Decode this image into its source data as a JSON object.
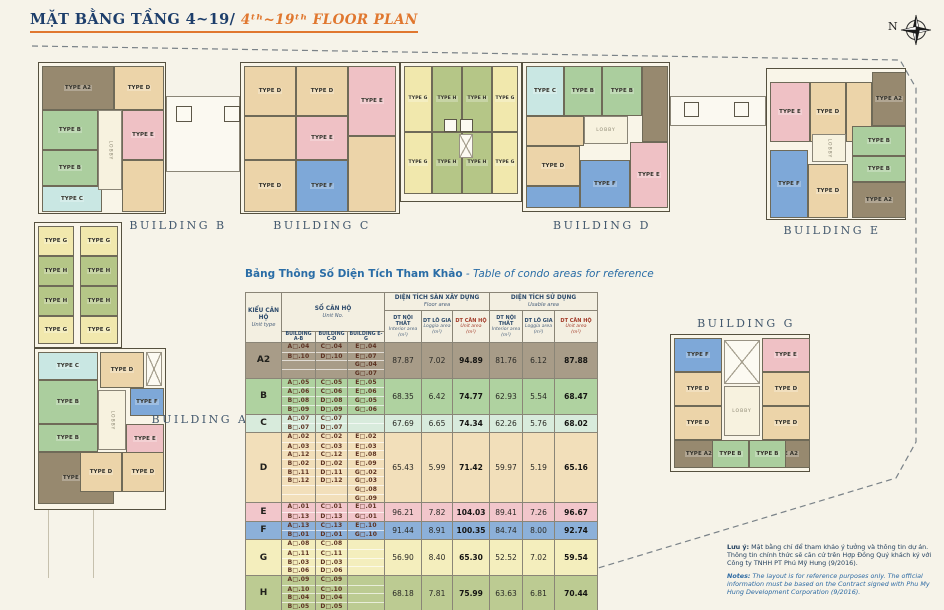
{
  "title": {
    "vi": "MẶT BẰNG TẦNG 4~19/ ",
    "en": "4ᵗʰ~19ᵗʰ FLOOR PLAN"
  },
  "compass": {
    "label": "N"
  },
  "plan": {
    "types": {
      "A2": {
        "label": "TYPE A2",
        "color": "#97896f"
      },
      "B": {
        "label": "TYPE B",
        "color": "#abce9e"
      },
      "C": {
        "label": "TYPE C",
        "color": "#c9e7e3"
      },
      "D": {
        "label": "TYPE D",
        "color": "#ecd4a9"
      },
      "E": {
        "label": "TYPE E",
        "color": "#efc1c5"
      },
      "F": {
        "label": "TYPE F",
        "color": "#7ea8d8"
      },
      "G": {
        "label": "TYPE G",
        "color": "#f1e8ad"
      },
      "H": {
        "label": "TYPE H",
        "color": "#b5c687"
      }
    },
    "lobby_label": "LOBBY",
    "buildings": [
      "BUILDING A",
      "BUILDING B",
      "BUILDING C",
      "BUILDING D",
      "BUILDING E",
      "BUILDING G"
    ]
  },
  "table": {
    "title_vi": "Bảng Thông Số Diện Tích Tham Khảo",
    "title_en": " - Table of condo areas for reference",
    "header": {
      "unit_type_vi": "KIỂU CĂN HỘ",
      "unit_type_en": "Unit type",
      "unit_no_vi": "SỐ CĂN HỘ",
      "unit_no_en": "Unit No.",
      "buildings": [
        "BUILDING A-B",
        "BUILDING C-D",
        "BUILDING E-G"
      ],
      "floor_vi": "DIỆN TÍCH SÀN XÂY DỰNG",
      "floor_en": "Floor area",
      "usable_vi": "DIỆN TÍCH SỬ DỤNG",
      "usable_en": "Usable area",
      "cols": [
        {
          "vi": "DT NỘI THẤT",
          "en": "Interior area",
          "unit": "(m²)",
          "highlight": false
        },
        {
          "vi": "DT LÔ GIA",
          "en": "Loggia area",
          "unit": "(m²)",
          "highlight": false
        },
        {
          "vi": "DT CĂN HỘ",
          "en": "Unit area",
          "unit": "(m²)",
          "highlight": true
        }
      ]
    },
    "rows": [
      {
        "type": "A2",
        "color": "#a89c88",
        "ab": [
          "A□.04",
          "B□.10",
          "",
          ""
        ],
        "cd": [
          "C□.04",
          "D□.10",
          "",
          ""
        ],
        "eg": [
          "E□.04",
          "E□.07",
          "G□.04",
          "G□.07"
        ],
        "floor": [
          "87.87",
          "7.02",
          "94.89"
        ],
        "usable": [
          "81.76",
          "6.12",
          "87.88"
        ]
      },
      {
        "type": "B",
        "color": "#afd2a0",
        "ab": [
          "A□.05",
          "A□.06",
          "B□.08",
          "B□.09"
        ],
        "cd": [
          "C□.05",
          "C□.06",
          "D□.08",
          "D□.09"
        ],
        "eg": [
          "E□.05",
          "E□.06",
          "G□.05",
          "G□.06"
        ],
        "floor": [
          "68.35",
          "6.42",
          "74.77"
        ],
        "usable": [
          "62.93",
          "5.54",
          "68.47"
        ]
      },
      {
        "type": "C",
        "color": "#d8ebdc",
        "ab": [
          "A□.07",
          "B□.07"
        ],
        "cd": [
          "C□.07",
          "D□.07"
        ],
        "eg": [
          "",
          ""
        ],
        "floor": [
          "67.69",
          "6.65",
          "74.34"
        ],
        "usable": [
          "62.26",
          "5.76",
          "68.02"
        ]
      },
      {
        "type": "D",
        "color": "#f2dfba",
        "ab": [
          "A□.02",
          "A□.03",
          "A□.12",
          "B□.02",
          "B□.11",
          "B□.12",
          "",
          ""
        ],
        "cd": [
          "C□.02",
          "C□.03",
          "C□.12",
          "D□.02",
          "D□.11",
          "D□.12",
          "",
          ""
        ],
        "eg": [
          "E□.02",
          "E□.03",
          "E□.08",
          "E□.09",
          "G□.02",
          "G□.03",
          "G□.08",
          "G□.09"
        ],
        "floor": [
          "65.43",
          "5.99",
          "71.42"
        ],
        "usable": [
          "59.97",
          "5.19",
          "65.16"
        ]
      },
      {
        "type": "E",
        "color": "#f2c6cb",
        "ab": [
          "A□.01",
          "B□.13"
        ],
        "cd": [
          "C□.01",
          "D□.13"
        ],
        "eg": [
          "E□.01",
          "G□.01"
        ],
        "floor": [
          "96.21",
          "7.82",
          "104.03"
        ],
        "usable": [
          "89.41",
          "7.26",
          "96.67"
        ]
      },
      {
        "type": "F",
        "color": "#8cb0d9",
        "ab": [
          "A□.13",
          "B□.01"
        ],
        "cd": [
          "C□.13",
          "D□.01"
        ],
        "eg": [
          "E□.10",
          "G□.10"
        ],
        "floor": [
          "91.44",
          "8.91",
          "100.35"
        ],
        "usable": [
          "84.74",
          "8.00",
          "92.74"
        ]
      },
      {
        "type": "G",
        "color": "#f4eebd",
        "ab": [
          "A□.08",
          "A□.11",
          "B□.03",
          "B□.06"
        ],
        "cd": [
          "C□.08",
          "C□.11",
          "D□.03",
          "D□.06"
        ],
        "eg": [
          "",
          "",
          "",
          ""
        ],
        "floor": [
          "56.90",
          "8.40",
          "65.30"
        ],
        "usable": [
          "52.52",
          "7.02",
          "59.54"
        ]
      },
      {
        "type": "H",
        "color": "#bccb92",
        "ab": [
          "A□.09",
          "A□.10",
          "B□.04",
          "B□.05"
        ],
        "cd": [
          "C□.09",
          "C□.10",
          "D□.04",
          "D□.05"
        ],
        "eg": [
          "",
          "",
          "",
          ""
        ],
        "floor": [
          "68.18",
          "7.81",
          "75.99"
        ],
        "usable": [
          "63.63",
          "6.81",
          "70.44"
        ]
      }
    ]
  },
  "notes": {
    "vi_label": "Lưu ý:",
    "vi_text": " Mặt bằng chỉ để tham khảo ý tưởng và thông tin dự án. Thông tin chính thức sẽ căn cứ trên Hợp Đồng Quý khách ký với Công ty TNHH PT Phú Mỹ Hưng (9/2016).",
    "en_label": "Notes:",
    "en_text": " The layout is for reference purposes only. The official information must be based on the Contract signed with Phu My Hung Development Corporation (9/2016)."
  }
}
